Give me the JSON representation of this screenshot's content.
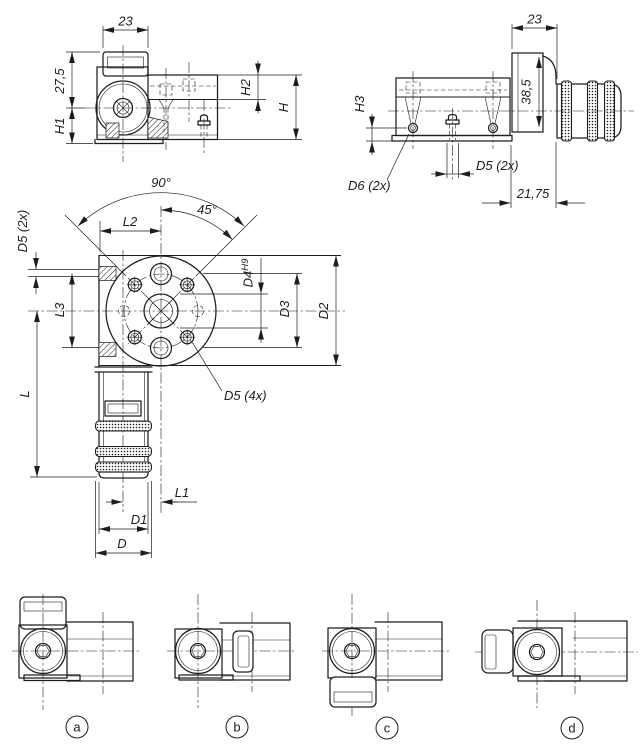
{
  "page": {
    "background": "#ffffff",
    "line_color": "#1d1d1b"
  },
  "views": {
    "front": {
      "name": "front elevation",
      "dims": {
        "width": "23",
        "height": "27,5",
        "h1": "H1",
        "h2": "H2",
        "h": "H"
      }
    },
    "side": {
      "name": "side elevation",
      "dims": {
        "width": "23",
        "height": "38,5",
        "h3": "H3",
        "d6": "D6 (2x)",
        "d5": "D5 (2x)",
        "offset": "21,75"
      }
    },
    "plan": {
      "name": "main flange view",
      "dims": {
        "angle_full": "90°",
        "angle_half": "45°",
        "l2": "L2",
        "d5_left": "D5 (2x)",
        "l3": "L3",
        "l": "L",
        "d4": "D4",
        "d4_tolerance": "H9",
        "d3": "D3",
        "d2": "D2",
        "d5_bolt_circle": "D5 (4x)",
        "l1": "L1",
        "d1": "D1",
        "d": "D"
      }
    },
    "variants": [
      {
        "label": "a"
      },
      {
        "label": "b"
      },
      {
        "label": "c"
      },
      {
        "label": "d"
      }
    ]
  }
}
